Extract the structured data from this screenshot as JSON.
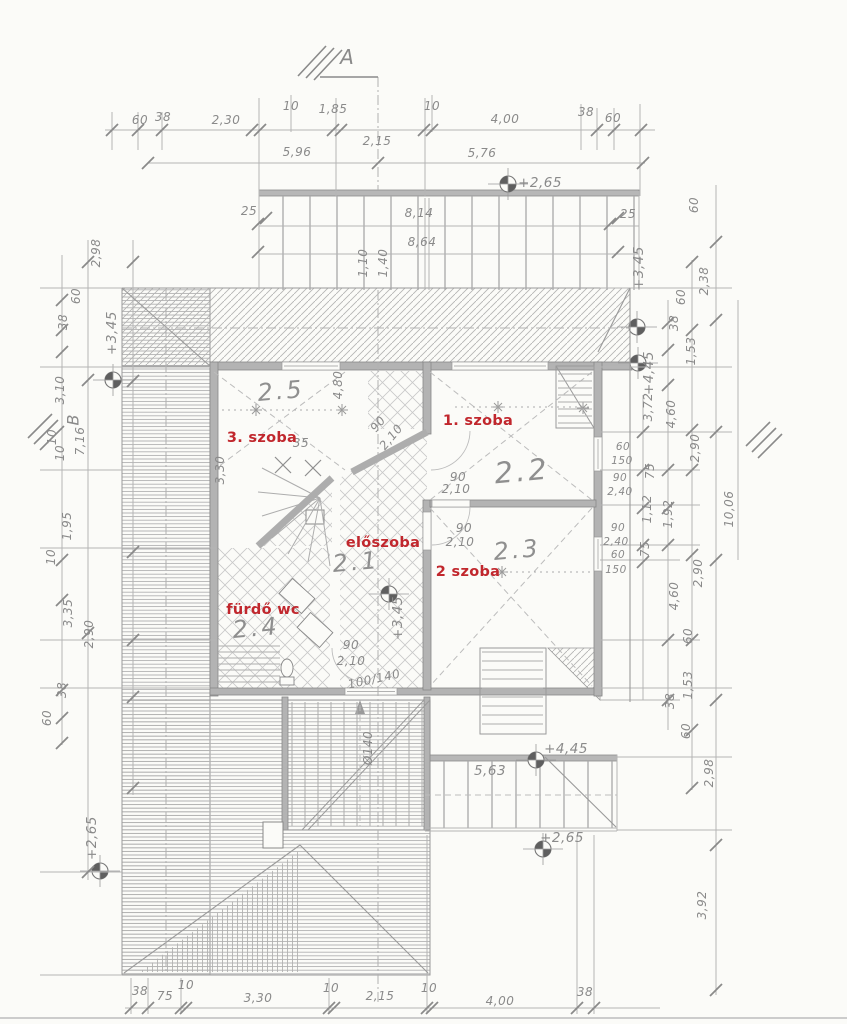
{
  "markers": {
    "section_a": "A",
    "section_b": "B"
  },
  "rooms": [
    {
      "number": "2.5",
      "name": "3. szoba"
    },
    {
      "number": "2.2",
      "name": "1. szoba"
    },
    {
      "number": "2.3",
      "name": "2 szoba"
    },
    {
      "number": "2.1",
      "name": "előszoba"
    },
    {
      "number": "2.4",
      "name": "fürdő wc"
    }
  ],
  "levels": {
    "top": "+2,65",
    "left_upper": "+3,45",
    "left_lower": "+2,65",
    "right_upper": "+3,45",
    "right_ridge": "+4,45",
    "hall": "+3,45",
    "lower_terrace": "+4,45",
    "lower_terrace2": "+2,65"
  },
  "dims": {
    "top1": [
      "60",
      "38",
      "2,30",
      "10",
      "1,85",
      "10",
      "4,00",
      "38",
      "60"
    ],
    "top_between": "2,15",
    "top2": [
      "5,96",
      "5,76"
    ],
    "balcony": [
      "25",
      "8,14",
      "8,64",
      "25",
      "1,10",
      "1,40"
    ],
    "left": [
      "2,98",
      "60",
      "38",
      "3,10",
      "10",
      "10",
      "7,16",
      "1,95",
      "10",
      "3,35",
      "2,90",
      "38",
      "60"
    ],
    "bottom": [
      "38",
      "75",
      "10",
      "3,30",
      "10",
      "2,15",
      "10",
      "4,00",
      "38"
    ],
    "right_outer": [
      "60",
      "2,38",
      "60",
      "38",
      "1,53",
      "3,72",
      "4,60",
      "2,90",
      "75",
      "1,12",
      "1,92",
      "10,06",
      "75"
    ],
    "right_wall": [
      "60",
      "150",
      "90",
      "2,40",
      "90",
      "2,40",
      "60",
      "150"
    ],
    "right_lower": [
      "4,60",
      "2,90",
      "60",
      "1,53",
      "38",
      "60",
      "2,98",
      "3,92"
    ],
    "interior": [
      "4,80",
      "3,30",
      "35",
      "90",
      "2,10",
      "90",
      "2,10",
      "90",
      "2,10",
      "90",
      "2,10",
      "100/140",
      "5,63",
      "Ø140"
    ]
  }
}
